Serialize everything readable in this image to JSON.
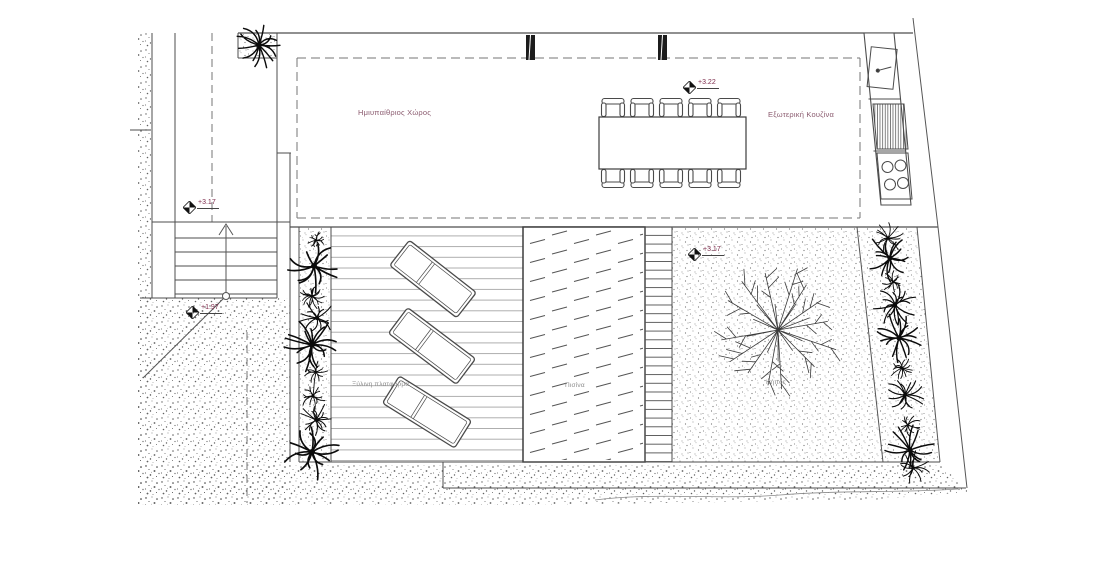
{
  "drawing": {
    "labels": {
      "semi_outdoor_space": "Ημιυπαίθριος Χώρος",
      "outdoor_kitchen": "Εξωτερική Κουζίνα",
      "wooden_platform": "Ξύλινη πλατφόρμα",
      "pool": "Πισίνα",
      "garden": "Κήπος"
    },
    "elevation_markers": [
      {
        "name": "pergola-level",
        "value": "+3.22"
      },
      {
        "name": "stair-top-level",
        "value": "+3.17"
      },
      {
        "name": "lower-ground-level",
        "value": "+1.97"
      },
      {
        "name": "garden-level",
        "value": "+3.17"
      }
    ],
    "furniture": {
      "dining_chairs": 10,
      "sun_loungers": 3,
      "dining_tables": 1
    },
    "colors": {
      "linework": "#4d4d4d",
      "dashed_line": "#757575",
      "room_label": "#8a5a6e",
      "area_label": "#8c8c8c",
      "elevation_text": "#7e2c4c",
      "plant": "#0b0b0b",
      "stipple": "#6f6f6f",
      "background": "#ffffff"
    }
  }
}
